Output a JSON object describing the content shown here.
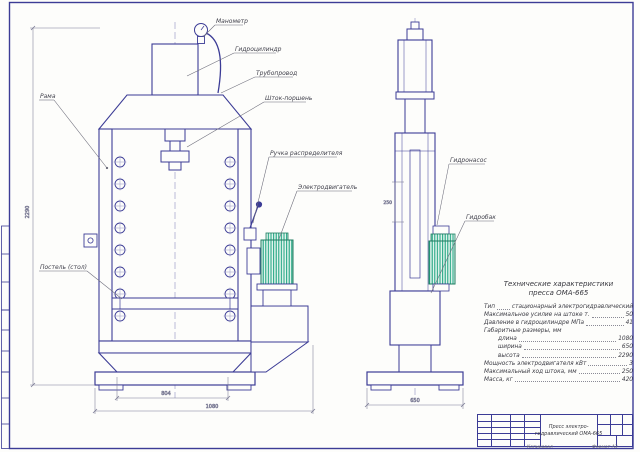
{
  "drawing": {
    "callouts": [
      {
        "id": "manometer",
        "text": "Манометр"
      },
      {
        "id": "hydrocylinder",
        "text": "Гидроцилиндр"
      },
      {
        "id": "pipeline",
        "text": "Трубопровод"
      },
      {
        "id": "rod-piston",
        "text": "Шток-поршень"
      },
      {
        "id": "frame",
        "text": "Рама"
      },
      {
        "id": "distributor-handle",
        "text": "Ручка распределителя"
      },
      {
        "id": "electric-motor",
        "text": "Электродвигатель"
      },
      {
        "id": "bed-table",
        "text": "Постель (стол)"
      },
      {
        "id": "hydro-pump",
        "text": "Гидронасос"
      },
      {
        "id": "hydro-tank",
        "text": "Гидробак"
      }
    ],
    "dimensions": {
      "overall_height": "2290",
      "base_width": "804",
      "overall_length": "1080",
      "side_width": "650",
      "stroke": "250"
    }
  },
  "specs": {
    "title_line1": "Технические характеристики",
    "title_line2": "пресса ОМА-665",
    "rows": [
      {
        "label": "Тип",
        "value": "стационарный электрогидравлический"
      },
      {
        "label": "Максимальное усилие на штоке т.",
        "value": "50"
      },
      {
        "label": "Давление в гидроцилиндре МПа",
        "value": "41"
      },
      {
        "label": "Габаритные размеры, мм",
        "value": ""
      },
      {
        "label": "длина",
        "value": "1080"
      },
      {
        "label": "ширина",
        "value": "650"
      },
      {
        "label": "высота",
        "value": "2290"
      },
      {
        "label": "Мощность электродвигателя кВт",
        "value": "3"
      },
      {
        "label": "Максимальный ход штока, мм",
        "value": "250"
      },
      {
        "label": "Масса, кг",
        "value": "420"
      }
    ]
  },
  "title_block": {
    "name_line1": "Пресс электро-",
    "name_line2": "гидравлический ОМА-665",
    "copied_label": "Копировал",
    "format_label": "Формат А3"
  },
  "colors": {
    "line": "#3c3c96",
    "thin_line": "#9a9ac6",
    "motor_hatch": "#15a07c",
    "text": "#3f3f4a"
  }
}
